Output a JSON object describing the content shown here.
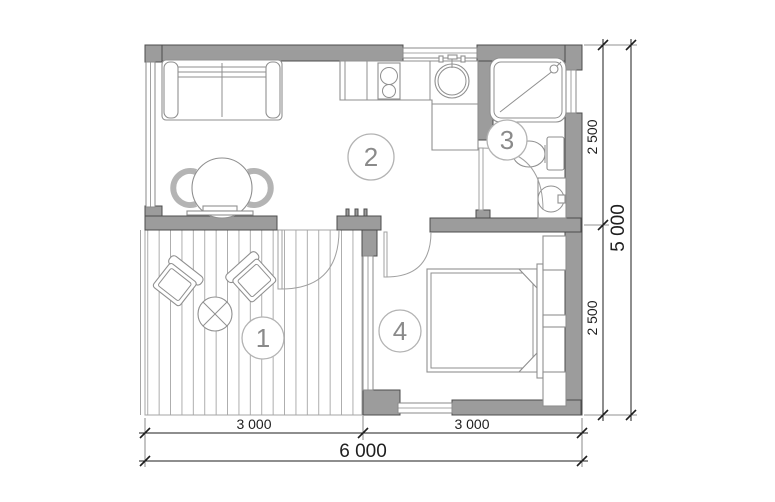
{
  "rooms": [
    {
      "number": "1"
    },
    {
      "number": "2"
    },
    {
      "number": "3"
    },
    {
      "number": "4"
    }
  ],
  "dimensions": {
    "bottom": {
      "segments": [
        "3 000",
        "3 000"
      ],
      "total": "6 000"
    },
    "right": {
      "segments": [
        "2 500",
        "2 500"
      ],
      "total": "5 000"
    }
  },
  "colors": {
    "background": "#ffffff",
    "wall_fill": "#9c9c9c",
    "wall_stroke": "#4c4c4c",
    "furniture_stroke": "#8f8f8f",
    "window_stroke": "#8a8a8a",
    "deck_line": "#a5a5a5",
    "door_arc": "#a0a0a0",
    "label_circle": "#b3b3b3",
    "label_color": "#8a8a8a",
    "dim_color": "#1e1e1e"
  }
}
